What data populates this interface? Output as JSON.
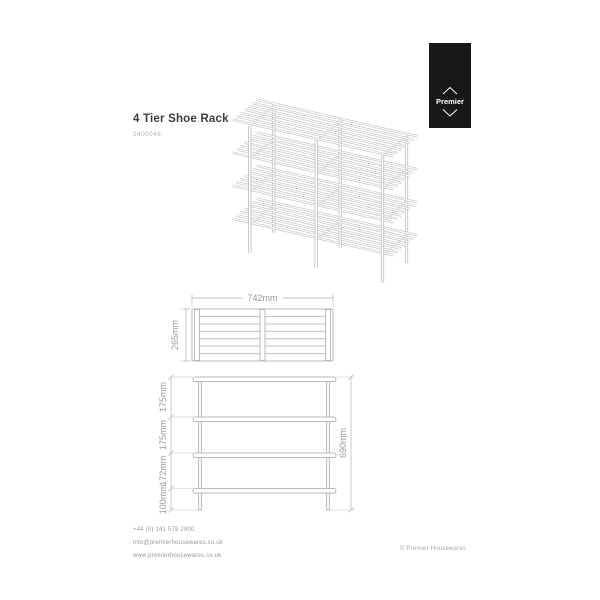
{
  "document": {
    "title": "4 Tier Shoe Rack",
    "product_code": "2400046"
  },
  "brand": {
    "name": "Premier"
  },
  "dimensions": {
    "top_view": {
      "width": "742mm",
      "depth": "265mm"
    },
    "front_view": {
      "segments": [
        "175mm",
        "175mm",
        "172mm",
        "100mm"
      ],
      "total_height": "690mm"
    }
  },
  "footer": {
    "phone": "+44 (0) 141 579 2000",
    "email": "info@premierhousewares.co.uk",
    "website": "www.premierhousewares.co.uk",
    "copyright": "© Premier Housewares"
  },
  "colors": {
    "drawing_line": "#c4c4c4",
    "dimension_text": "#9a9a9a",
    "title_text": "#3d3d3d",
    "badge_background": "#181818",
    "badge_text": "#ffffff"
  }
}
